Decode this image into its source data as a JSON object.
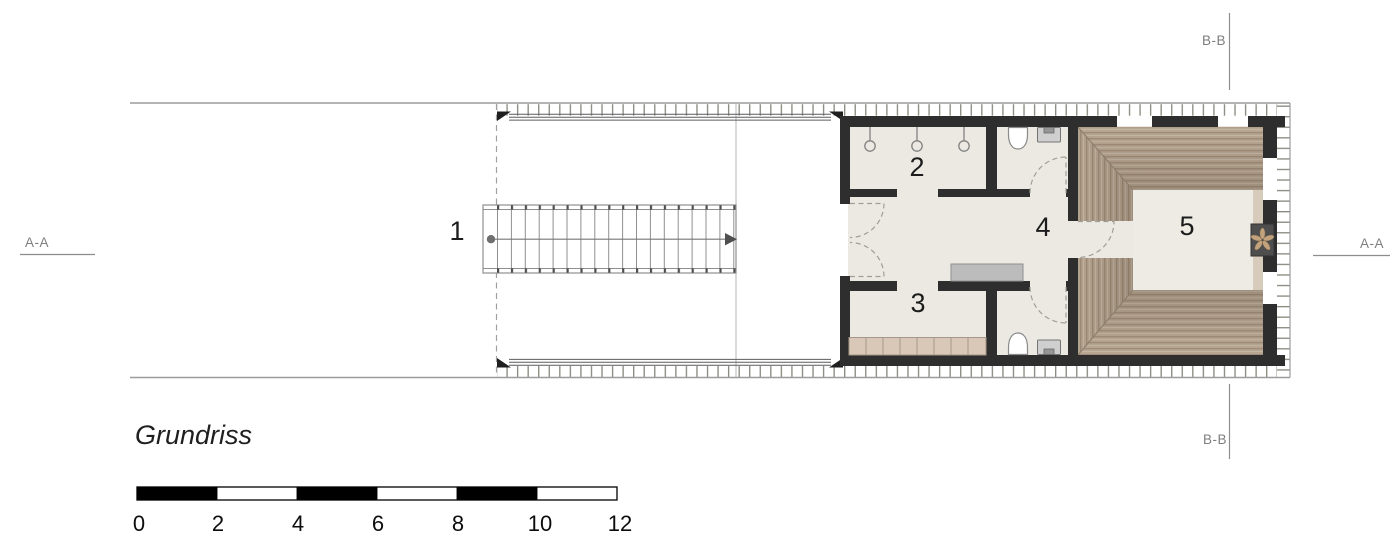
{
  "plan": {
    "title": "Grundriss",
    "room_labels": {
      "stair": "1",
      "room2": "2",
      "room3": "3",
      "room4": "4",
      "room5": "5"
    },
    "section_markers": {
      "aa_left": "A-A",
      "aa_right": "A-A",
      "bb_top": "B-B",
      "bb_bottom": "B-B"
    },
    "scale_bar": {
      "tick_labels": [
        "0",
        "2",
        "4",
        "6",
        "8",
        "10",
        "12"
      ],
      "segment_count": 6
    },
    "colors": {
      "wall": "#2e2e2e",
      "floor": "#ebe9e2",
      "wood_base": "#b7a793",
      "closet": "#d9c8b7",
      "sideboard": "#bcbcbc",
      "beige_strip": "#d7cbbc",
      "stove": "#4e4e4e",
      "marker_gray": "#8d8d8d",
      "scale_black": "#000000"
    }
  }
}
